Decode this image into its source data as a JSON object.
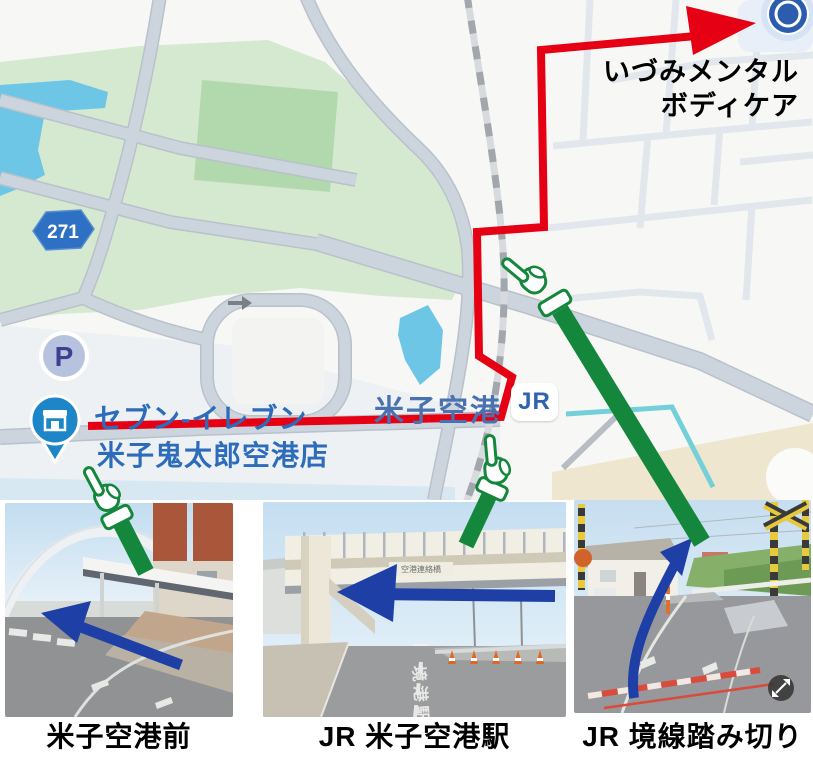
{
  "destination": {
    "line1": "いづみメンタル",
    "line2": "ボディケア"
  },
  "map": {
    "route_number": "271",
    "parking": "P",
    "store_line1": "セブン-イレブン",
    "store_line2": "米子鬼太郎空港店",
    "station_name": "米子空港",
    "jr": "JR"
  },
  "photos": [
    {
      "caption": "米子空港前"
    },
    {
      "caption": "JR 米子空港駅",
      "bridge_sign": "空港連絡橋",
      "road_paint": "境港駅"
    },
    {
      "caption": "JR 境線踏み切り"
    }
  ],
  "colors": {
    "route_red": "#e60013",
    "arm_green": "#14873c",
    "arrow_blue": "#1d3fa6",
    "station_blue": "#4a72b0",
    "store_blue": "#2d6cba",
    "jr_blue": "#2f63b0",
    "park_green": "#d5e9d1",
    "water_blue": "#6ec6e6",
    "canal_teal": "#74d0d8",
    "road_gray": "#ccd4dd"
  }
}
